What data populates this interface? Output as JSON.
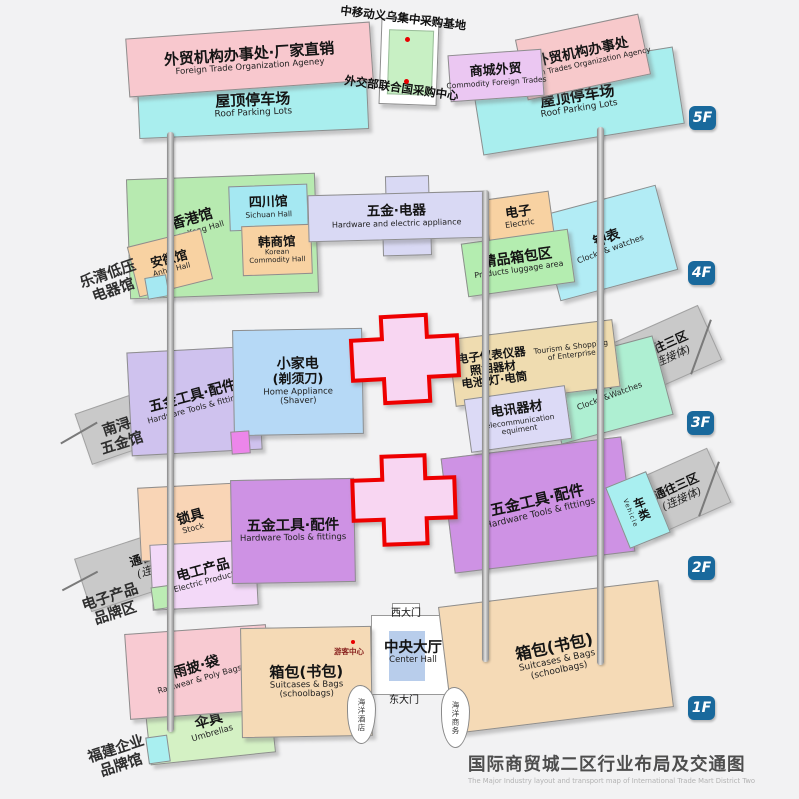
{
  "caption": {
    "zh": "国际商贸城二区行业布局及交通图",
    "en": "The Major Industry layout and transport map of International Trade Mart District Two"
  },
  "palette": {
    "floor_badge_blue": "#19699c",
    "atrium_border_red": "#ee0000",
    "marker_dot_red": "#e80000",
    "connector_gray": "#c9c9c9"
  },
  "annotations": {
    "mobile_base": "中移动义乌集中采购基地",
    "un_center": "外交部联合国采购中心",
    "tourist_center": "游客中心",
    "west_gate": "西大门",
    "east_gate": "东大门",
    "ocean_hotel": "海洋酒店",
    "ocean_business": "海洋商务"
  },
  "side_labels": {
    "yueqing": [
      "乐清低压",
      "电器馆"
    ],
    "nanxun": [
      "南浔",
      "五金馆"
    ],
    "electronics_brand": [
      "电子产品",
      "品牌区"
    ],
    "fujian": [
      "福建企业",
      "品牌馆"
    ]
  },
  "floors": {
    "f5": {
      "badge": "5F",
      "agency_left": {
        "zh": "外贸机构办事处·厂家直销",
        "en": "Foreign Trade Organization Ageney"
      },
      "parking_left": {
        "zh": "屋顶停车场",
        "en": "Roof Parking Lots"
      },
      "commodity": {
        "zh": "商城外贸",
        "en": "Commodity Foreign Trades"
      },
      "agency_right": {
        "zh": "外贸机构办事处",
        "en": "Foreign Trades Organization Agency"
      },
      "parking_right": {
        "zh": "屋顶停车场",
        "en": "Roof Parking Lots"
      }
    },
    "f4": {
      "badge": "4F",
      "hongkong": {
        "zh": "香港馆",
        "en": "HongKong Hall"
      },
      "sichuan": {
        "zh": "四川馆",
        "en": "Sichuan Hall"
      },
      "korean": {
        "zh": "韩商馆",
        "en1": "Korean",
        "en2": "Commodity Hall"
      },
      "anhui": {
        "zh": "安徽馆",
        "en": "Anhui Hall"
      },
      "hardware_electric": {
        "zh": "五金·电器",
        "en": "Hardware and electric appliance"
      },
      "electric": {
        "zh": "电子",
        "en": "Electric"
      },
      "luggage": {
        "zh": "精品箱包区",
        "en": "Products luggage area"
      },
      "clocks": {
        "zh": "钟表",
        "en": "Clocks & watches"
      }
    },
    "f3": {
      "badge": "3F",
      "connector_west": {
        "zh": "通往一区",
        "sub": "(连接体)"
      },
      "tools": {
        "zh": "五金工具·配件",
        "en": "Hardware Tools & fittings"
      },
      "home_appliance": {
        "zh1": "小家电",
        "zh2": "(剃须刀)",
        "en1": "Home Appliance",
        "en2": "(Shaver)"
      },
      "instruments": {
        "zh1": "电子仪表仪器",
        "zh2": "照相器材",
        "zh3": "电池·灯·电筒",
        "en1": "Tourism & Shopping",
        "en2": "of Enterprise"
      },
      "telecom": {
        "zh": "电讯器材",
        "en1": "Telecommunication",
        "en2": "equiment"
      },
      "clocks": {
        "zh": "钟表",
        "en": "Clocks &Watches"
      },
      "connector_east": {
        "zh": "通往三区",
        "sub": "(连接体)"
      }
    },
    "f2": {
      "badge": "2F",
      "connector_west": {
        "zh": "通往一区",
        "sub": "(连接体)"
      },
      "locks": {
        "zh": "锁具",
        "en": "Stock"
      },
      "electric_products": {
        "zh": "电工产品",
        "en": "Electric Products"
      },
      "tools_west": {
        "zh": "五金工具·配件",
        "en": "Hardware Tools & fittings"
      },
      "tools_east": {
        "zh": "五金工具·配件",
        "en": "Hardware Tools & fittings"
      },
      "vehicle": {
        "zh": "车类",
        "en": "Vehicle"
      },
      "connector_east": {
        "zh": "通往三区",
        "sub": "(连接体)"
      }
    },
    "f1": {
      "badge": "1F",
      "rainwear": {
        "zh": "雨披·袋",
        "en": "Rainwear & Poly Bags"
      },
      "umbrellas": {
        "zh": "伞具",
        "en": "Umbrellas"
      },
      "suitcases_west": {
        "zh": "箱包(书包)",
        "en1": "Suitcases & Bags",
        "en2": "(schoolbags)"
      },
      "suitcases_east": {
        "zh": "箱包(书包)",
        "en1": "Suitcases & Bags",
        "en2": "(schoolbags)"
      },
      "center_hall": {
        "zh": "中央大厅",
        "en": "Center Hall"
      }
    }
  }
}
